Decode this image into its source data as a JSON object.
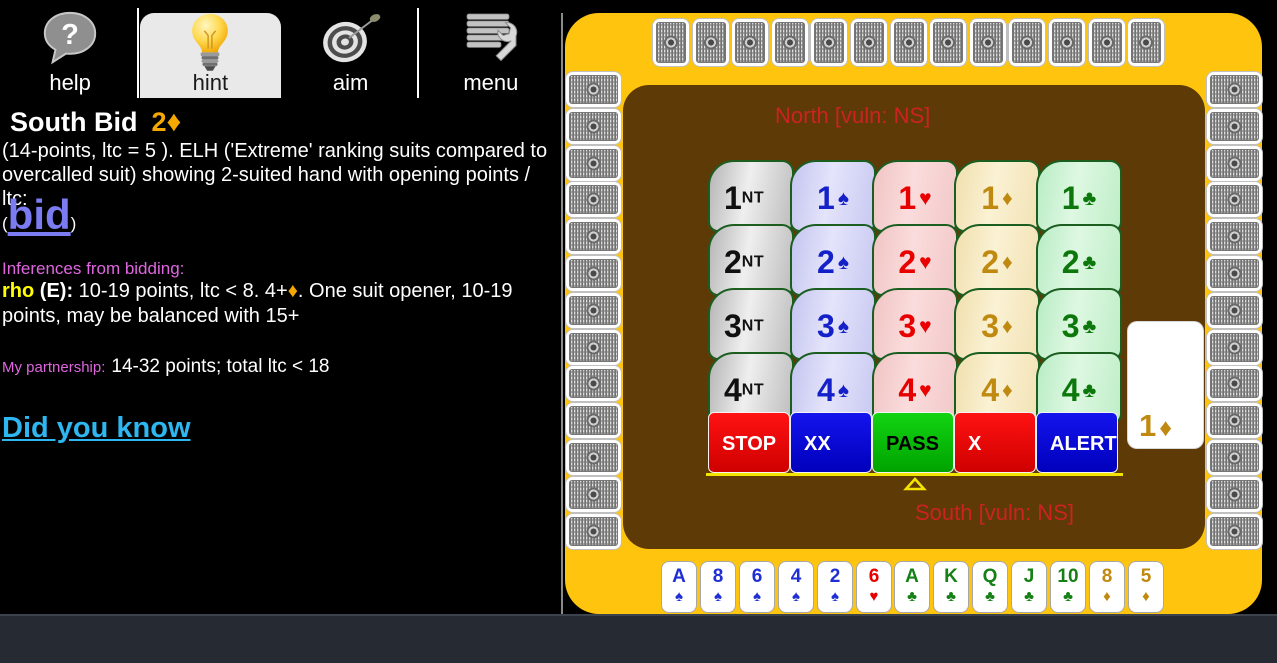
{
  "toolbar": {
    "items": [
      {
        "label": "help",
        "icon": "help-bubble-icon",
        "selected": false
      },
      {
        "label": "hint",
        "icon": "lightbulb-icon",
        "selected": true
      },
      {
        "label": "aim",
        "icon": "dartboard-icon",
        "selected": false
      },
      {
        "label": "menu",
        "icon": "menu-wrench-icon",
        "selected": false
      }
    ]
  },
  "info_panel": {
    "title": "South Bid",
    "title_level": "2",
    "title_suit": "♦",
    "description": "(14-points, ltc = 5 ).  ELH ('Extreme' ranking suits compared to overcalled suit) showing 2-suited hand with opening points / ltc:",
    "bid_link": {
      "open_paren": "(",
      "label": "bid",
      "close_paren": ")"
    },
    "inferences_heading": "Inferences from bidding:",
    "rho": {
      "name": "rho",
      "seat": "(E):",
      "text_before": "10-19 points, ltc < 8. 4+",
      "suit": "♦",
      "text_after": ". One suit opener, 10-19 points, may be balanced with 15+"
    },
    "partnership": {
      "label": "My partnership:",
      "value": "14-32 points; total ltc < 18"
    },
    "did_you_know": "Did you know"
  },
  "table": {
    "north_label": "North [vuln: NS]",
    "south_label": "South [vuln: NS]",
    "current_bid": {
      "level": "1",
      "suit_symbol": "♦"
    },
    "hidden_hands": {
      "north": 13,
      "west": 13,
      "east": 13
    },
    "bidding_box": {
      "levels": [
        "1",
        "2",
        "3",
        "4"
      ],
      "suits": [
        {
          "key": "nt",
          "label": "NT"
        },
        {
          "key": "spade",
          "symbol": "♠"
        },
        {
          "key": "heart",
          "symbol": "♥"
        },
        {
          "key": "diamond",
          "symbol": "♦"
        },
        {
          "key": "club",
          "symbol": "♣"
        }
      ],
      "actions": [
        {
          "label": "STOP",
          "style": "red"
        },
        {
          "label": "XX",
          "style": "blue"
        },
        {
          "label": "PASS",
          "style": "green"
        },
        {
          "label": "X",
          "style": "red"
        },
        {
          "label": "ALERT",
          "style": "blue"
        }
      ]
    },
    "hand": [
      {
        "rank": "A",
        "suit": "spade"
      },
      {
        "rank": "8",
        "suit": "spade"
      },
      {
        "rank": "6",
        "suit": "spade"
      },
      {
        "rank": "4",
        "suit": "spade"
      },
      {
        "rank": "2",
        "suit": "spade"
      },
      {
        "rank": "6",
        "suit": "heart"
      },
      {
        "rank": "A",
        "suit": "club"
      },
      {
        "rank": "K",
        "suit": "club"
      },
      {
        "rank": "Q",
        "suit": "club"
      },
      {
        "rank": "J",
        "suit": "club"
      },
      {
        "rank": "10",
        "suit": "club"
      },
      {
        "rank": "8",
        "suit": "diamond"
      },
      {
        "rank": "5",
        "suit": "diamond"
      }
    ]
  },
  "suit_symbols": {
    "spade": "♠",
    "heart": "♥",
    "diamond": "♦",
    "club": "♣"
  },
  "colors": {
    "panel_gold": "#FFC40D",
    "table_brown": "#5E3A07",
    "vuln_red": "#CC2222",
    "accent_orange": "#F5A800",
    "bid_link_blue": "#7B7BF2",
    "did_you_know_cyan": "#2EB6F0",
    "heading_magenta": "#E066E0",
    "rho_yellow": "#FFFF00",
    "suit_spade": "#1F2FD4",
    "suit_heart": "#E80000",
    "suit_club": "#158015",
    "suit_diamond": "#C08A10"
  }
}
